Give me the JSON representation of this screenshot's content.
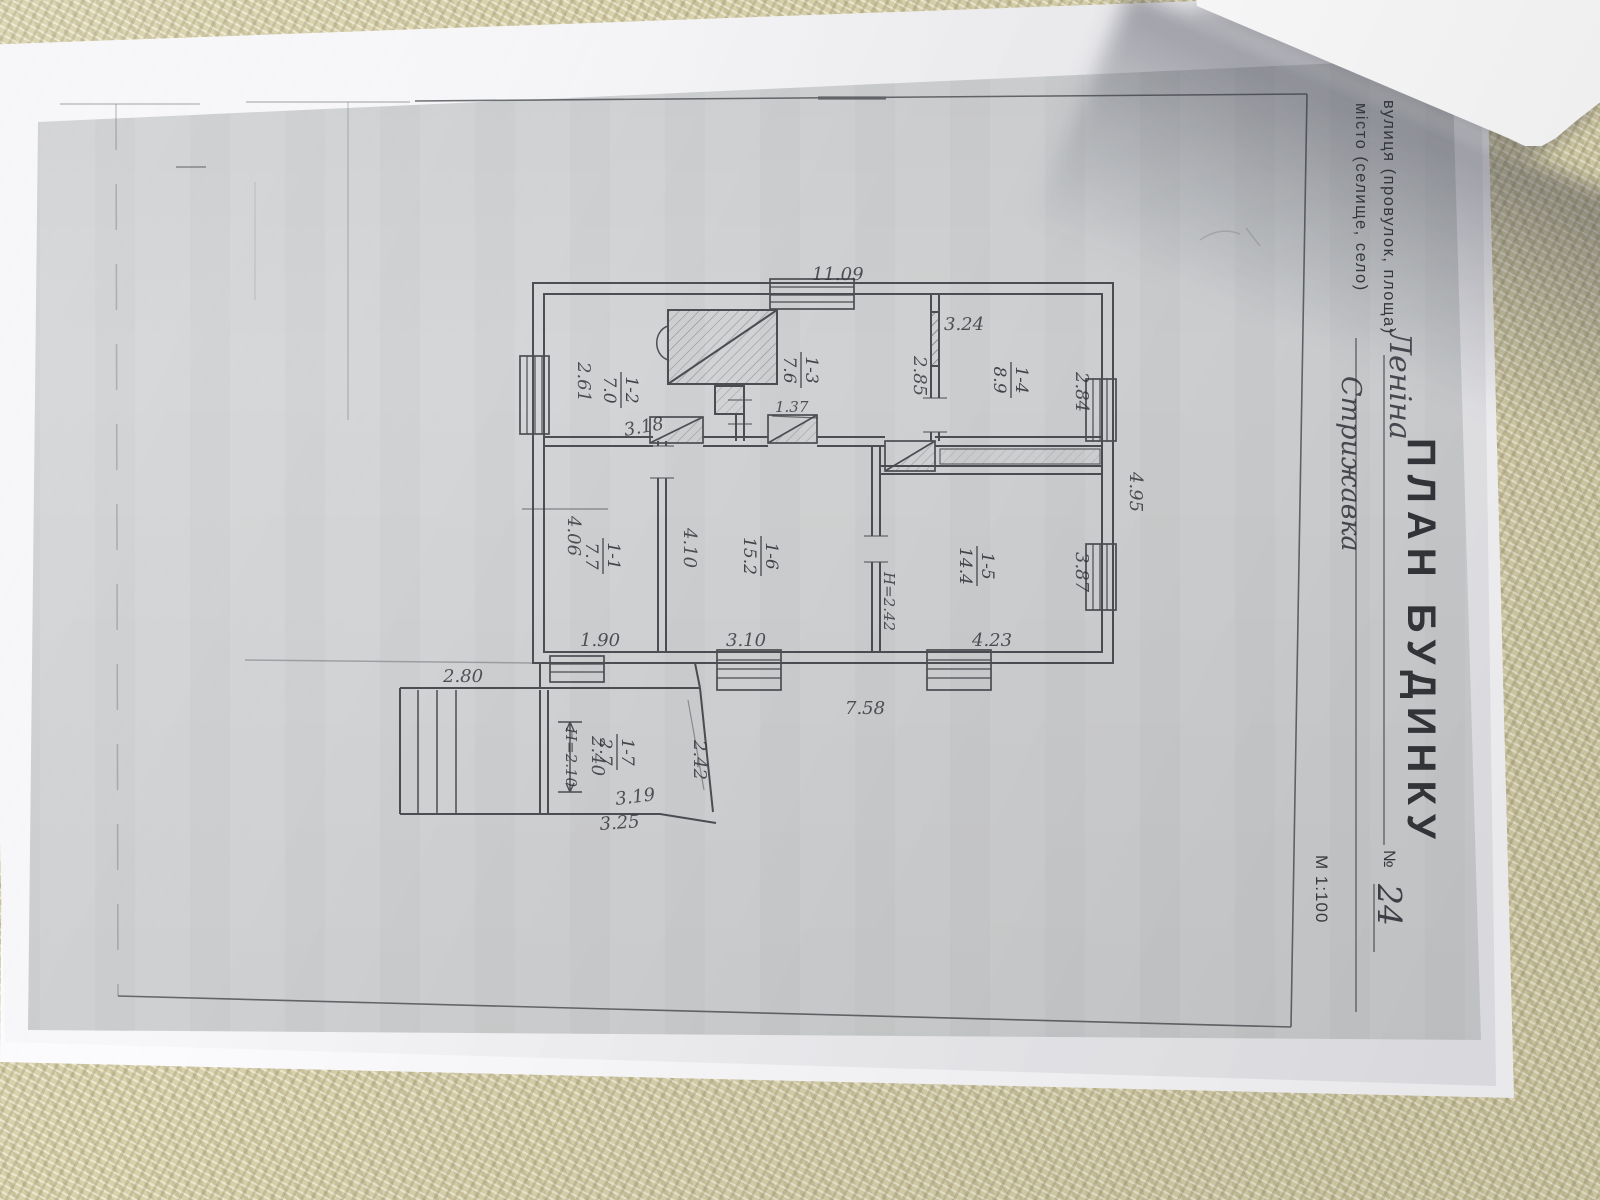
{
  "header": {
    "title": "ПЛАН БУДИНКУ",
    "street_label": "вулиця (провулок, площа)",
    "street_value": "Леніна",
    "number_label": "№",
    "number_value": "24",
    "city_label": "місто (селище, село)",
    "city_value": "Стрижавка",
    "scale": "М 1:100"
  },
  "rooms": [
    {
      "number": "1-1",
      "area": "7.7"
    },
    {
      "number": "1-2",
      "area": "7.0"
    },
    {
      "number": "1-3",
      "area": "7.6"
    },
    {
      "number": "1-4",
      "area": "8.9"
    },
    {
      "number": "1-5",
      "area": "14.4"
    },
    {
      "number": "1-6",
      "area": "15.2"
    },
    {
      "number": "1-7",
      "area": "2.7"
    }
  ],
  "dims": {
    "top_overall": "11.09",
    "bottom_overall": "7.58",
    "right_overall": "4.95",
    "room12_depth": "2.61",
    "room12_door": "3.18",
    "room13_door": "1.37",
    "room13_right": "2.85",
    "room14_width": "3.24",
    "room14_depth": "2.84",
    "room15_width": "4.23",
    "room15_depth": "3.87",
    "room15_height": "Н=2.42",
    "room11_width": "1.90",
    "room11_depth": "4.06",
    "room16_width": "3.10",
    "room16_depth": "4.10",
    "annex_width": "2.80",
    "annex_inner": "2.40",
    "annex_height": "Н=2.10",
    "annex_right": "2.42",
    "annex_bottom_inner": "3.19",
    "annex_bottom_outer": "3.25"
  }
}
